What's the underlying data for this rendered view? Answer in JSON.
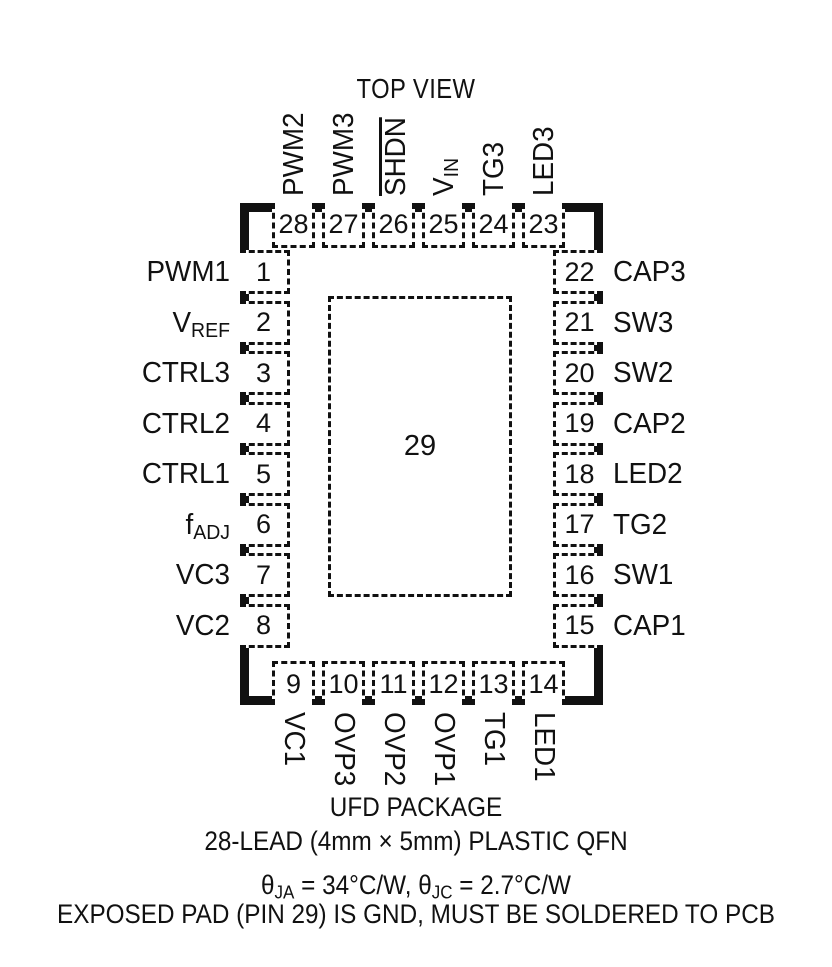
{
  "title": "TOP VIEW",
  "ink_color": "#111111",
  "package": {
    "exposed_pad_number": "29",
    "pins": {
      "top": [
        {
          "num": "28",
          "label": [
            {
              "t": "PWM2"
            }
          ]
        },
        {
          "num": "27",
          "label": [
            {
              "t": "PWM3"
            }
          ]
        },
        {
          "num": "26",
          "label": [
            {
              "over": "SHDN"
            }
          ]
        },
        {
          "num": "25",
          "label": [
            {
              "t": "V"
            },
            {
              "sub": "IN"
            }
          ]
        },
        {
          "num": "24",
          "label": [
            {
              "t": "TG3"
            }
          ]
        },
        {
          "num": "23",
          "label": [
            {
              "t": "LED3"
            }
          ]
        }
      ],
      "left": [
        {
          "num": "1",
          "label": [
            {
              "t": "PWM1"
            }
          ]
        },
        {
          "num": "2",
          "label": [
            {
              "t": "V"
            },
            {
              "sub": "REF"
            }
          ]
        },
        {
          "num": "3",
          "label": [
            {
              "t": "CTRL3"
            }
          ]
        },
        {
          "num": "4",
          "label": [
            {
              "t": "CTRL2"
            }
          ]
        },
        {
          "num": "5",
          "label": [
            {
              "t": "CTRL1"
            }
          ]
        },
        {
          "num": "6",
          "label": [
            {
              "t": "f"
            },
            {
              "sub": "ADJ"
            }
          ]
        },
        {
          "num": "7",
          "label": [
            {
              "t": "VC3"
            }
          ]
        },
        {
          "num": "8",
          "label": [
            {
              "t": "VC2"
            }
          ]
        }
      ],
      "right": [
        {
          "num": "22",
          "label": [
            {
              "t": "CAP3"
            }
          ]
        },
        {
          "num": "21",
          "label": [
            {
              "t": "SW3"
            }
          ]
        },
        {
          "num": "20",
          "label": [
            {
              "t": "SW2"
            }
          ]
        },
        {
          "num": "19",
          "label": [
            {
              "t": "CAP2"
            }
          ]
        },
        {
          "num": "18",
          "label": [
            {
              "t": "LED2"
            }
          ]
        },
        {
          "num": "17",
          "label": [
            {
              "t": "TG2"
            }
          ]
        },
        {
          "num": "16",
          "label": [
            {
              "t": "SW1"
            }
          ]
        },
        {
          "num": "15",
          "label": [
            {
              "t": "CAP1"
            }
          ]
        }
      ],
      "bottom": [
        {
          "num": "9",
          "label": [
            {
              "t": "VC1"
            }
          ]
        },
        {
          "num": "10",
          "label": [
            {
              "t": "OVP3"
            }
          ]
        },
        {
          "num": "11",
          "label": [
            {
              "t": "OVP2"
            }
          ]
        },
        {
          "num": "12",
          "label": [
            {
              "t": "OVP1"
            }
          ]
        },
        {
          "num": "13",
          "label": [
            {
              "t": "TG1"
            }
          ]
        },
        {
          "num": "14",
          "label": [
            {
              "t": "LED1"
            }
          ]
        }
      ]
    }
  },
  "captions": [
    "UFD PACKAGE",
    "28-LEAD (4mm × 5mm) PLASTIC QFN"
  ],
  "notes": [
    {
      "segments": [
        {
          "t": "θ"
        },
        {
          "sub": "JA"
        },
        {
          "t": " = 34°C/W, θ"
        },
        {
          "sub": "JC"
        },
        {
          "t": " = 2.7°C/W"
        }
      ]
    },
    {
      "segments": [
        {
          "t": "EXPOSED PAD (PIN 29) IS GND, MUST BE SOLDERED TO PCB"
        }
      ]
    }
  ]
}
